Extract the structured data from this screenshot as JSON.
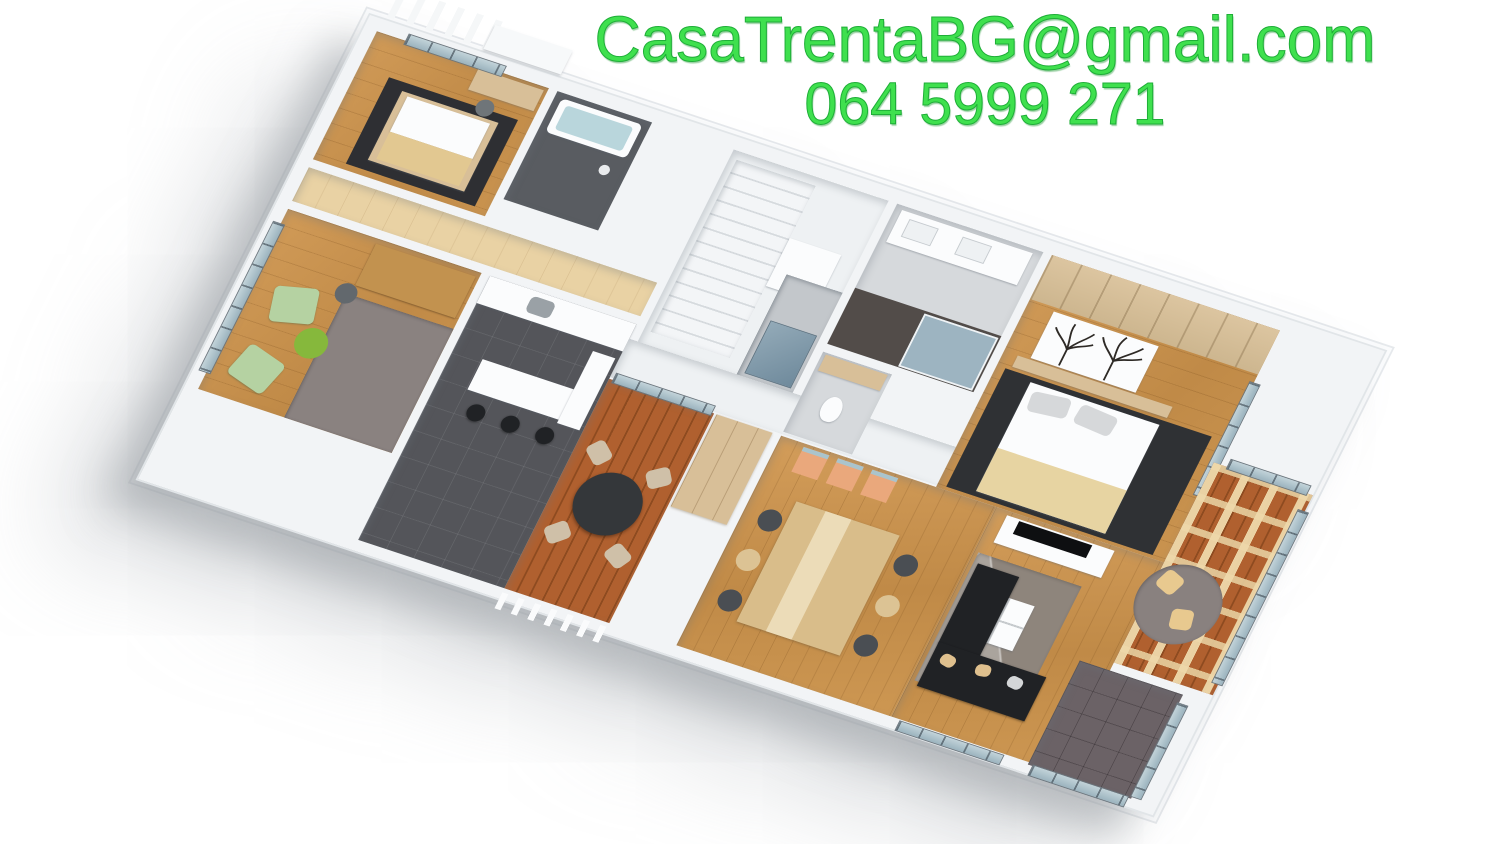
{
  "overlay": {
    "email": "CasaTrentaBG@gmail.com",
    "phone": "064 5999 271",
    "text_color": "#3fe04e"
  },
  "scene": {
    "kind": "3D rendered apartment floor plan, aerial oblique view on white background",
    "rooms": [
      {
        "id": "small-bedroom",
        "features": [
          "single bed on dark rug",
          "desk with gray chair",
          "corner windows"
        ]
      },
      {
        "id": "bathroom-dark",
        "features": [
          "white bathtub with water",
          "dark gray walls",
          "round wall lamp"
        ]
      },
      {
        "id": "hallway",
        "features": [
          "light wood floor"
        ]
      },
      {
        "id": "home-office",
        "features": [
          "wood desk with office chair",
          "two green armchairs",
          "green round side table",
          "gray rug",
          "window wall"
        ]
      },
      {
        "id": "kitchen",
        "features": [
          "dark tile floor",
          "white counters",
          "island with three black bar stools",
          "steel sink"
        ]
      },
      {
        "id": "stair-hall",
        "features": [
          "white staircase",
          "white landing"
        ]
      },
      {
        "id": "elevator",
        "features": [
          "gray shaft",
          "blue-gray door"
        ]
      },
      {
        "id": "wardrobe",
        "features": [
          "beige wood front"
        ]
      },
      {
        "id": "terrace",
        "features": [
          "red-brown deck boards",
          "round dark table",
          "four light chairs",
          "white louver fence"
        ]
      },
      {
        "id": "master-bathroom",
        "features": [
          "white double vanity",
          "glass shower",
          "dark tiles"
        ]
      },
      {
        "id": "wc",
        "features": [
          "toilet",
          "beige shelf"
        ]
      },
      {
        "id": "master-bedroom",
        "features": [
          "double bed with beige duvet",
          "dark rug",
          "wood headboard wall",
          "tree silhouette artwork",
          "side window"
        ]
      },
      {
        "id": "dining-room",
        "features": [
          "light wood table with runner",
          "six shell chairs dark and beige",
          "three peach stools"
        ]
      },
      {
        "id": "living-room",
        "features": [
          "black corner sofa with beige pillows",
          "white square coffee table",
          "marble-pattern gray rug",
          "white TV sideboard with black TV"
        ]
      },
      {
        "id": "sunroom",
        "features": [
          "pergola beam grid",
          "round gray rug",
          "two beige floor cushions",
          "deck floor",
          "windows"
        ]
      },
      {
        "id": "balcony",
        "features": [
          "dark tile floor",
          "glass railing"
        ]
      }
    ],
    "palette": {
      "wood_floor": "#c6914e",
      "light_wood": "#e9d2a4",
      "deck": "#a65a2b",
      "dark_tile": "#54555a",
      "balcony_tile": "#6b6266",
      "rug_dark": "#2f3134",
      "rug_gray": "#8a8280",
      "glass": "#a9c1cc",
      "wall": "#f2f4f6",
      "green_chair": "#b5d2a2",
      "green_table": "#86b83c",
      "black_furniture": "#202225",
      "beige": "#d8bf98",
      "background": "#ffffff"
    }
  }
}
